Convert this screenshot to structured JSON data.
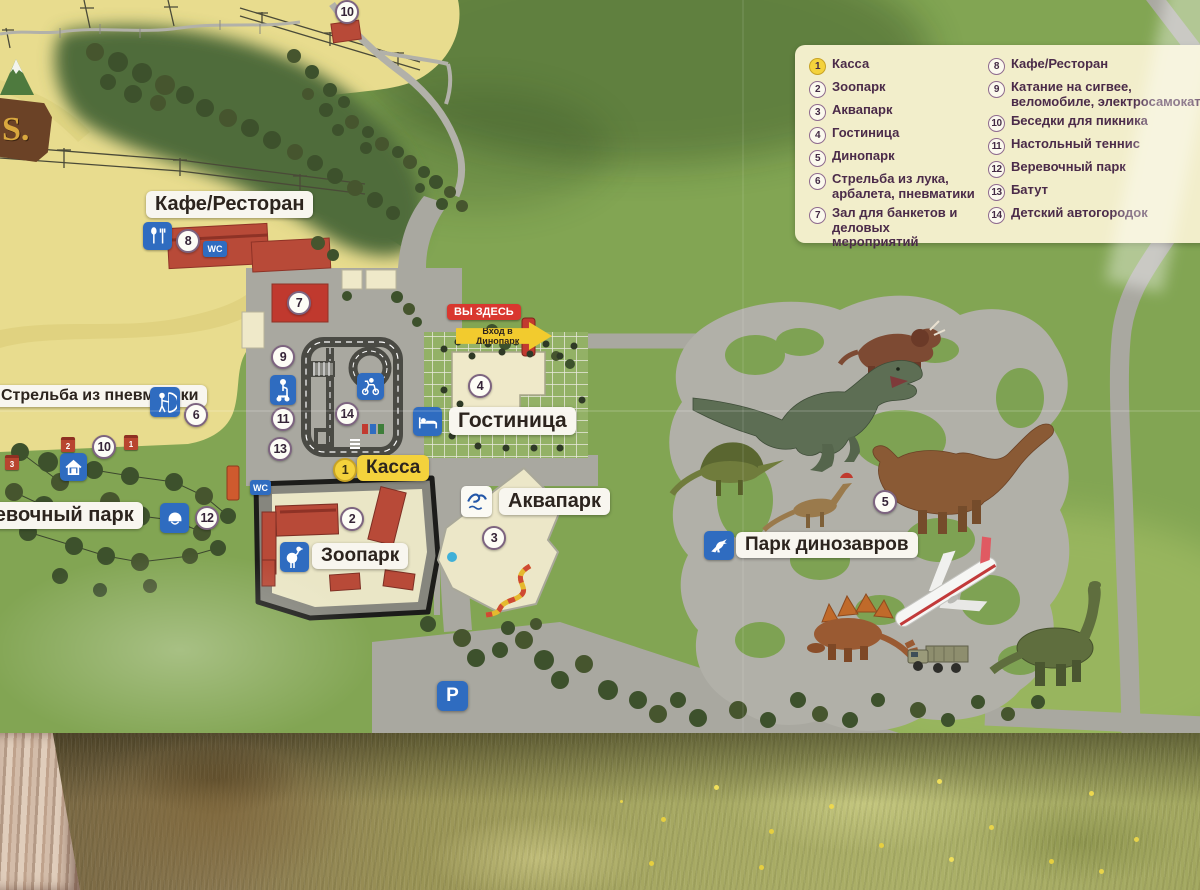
{
  "sign": {
    "legend": {
      "items": [
        {
          "num": "1",
          "label": "Касса",
          "highlight": true
        },
        {
          "num": "2",
          "label": "Зоопарк"
        },
        {
          "num": "3",
          "label": "Аквапарк"
        },
        {
          "num": "4",
          "label": "Гостиница"
        },
        {
          "num": "5",
          "label": "Динопарк"
        },
        {
          "num": "6",
          "label": "Стрельба из лука, арбалета, пневматики"
        },
        {
          "num": "7",
          "label": "Зал для банкетов и деловых мероприятий"
        },
        {
          "num": "8",
          "label": "Кафе/Ресторан"
        },
        {
          "num": "9",
          "label": "Катание на сигвее, веломобиле, электросамокате"
        },
        {
          "num": "10",
          "label": "Беседки для пикника"
        },
        {
          "num": "11",
          "label": "Настольный теннис"
        },
        {
          "num": "12",
          "label": "Веревочный парк"
        },
        {
          "num": "13",
          "label": "Батут"
        },
        {
          "num": "14",
          "label": "Детский автогородок"
        }
      ]
    },
    "labels": {
      "cafe": "Кафе/Ресторан",
      "shooting_range": "Стрельба из пневматики",
      "rope_park": "Веревочный парк",
      "zoo": "Зоопарк",
      "ticket_office": "Касса",
      "hotel": "Гостиница",
      "aquapark": "Аквапарк",
      "dino_park": "Парк динозавров",
      "you_are_here": "ВЫ ЗДЕСЬ",
      "dino_entrance": "Вход в Динопарк",
      "wc": "WC",
      "parking": "P",
      "logo": "S."
    },
    "markers": {
      "m1": "1",
      "m2": "2",
      "m3": "3",
      "m4": "4",
      "m5": "5",
      "m6": "6",
      "m7": "7",
      "m8": "8",
      "m9": "9",
      "m10": "10",
      "m11": "11",
      "m12": "12",
      "m13": "13",
      "m14": "14",
      "gazebo1": "1",
      "gazebo2": "2",
      "gazebo3": "3"
    },
    "colors": {
      "marker_highlight": "#f4d23c",
      "badge_blue": "#2f6cc0",
      "label_bg": "#f8f6ef",
      "you_are_here_bg": "#d9372f",
      "legend_bg": "#f2eecb",
      "legend_text": "#4b2b49",
      "map_green": "#82a553",
      "slope_yellow": "#e8dc8e"
    },
    "icons": [
      "restaurant-icon",
      "wc-badge",
      "segway-icon",
      "moped-icon",
      "bed-icon",
      "aquapark-logo-icon",
      "ostrich-icon",
      "archer-icon",
      "picnic-house-icon",
      "helmet-icon",
      "dino-icon",
      "parking-icon"
    ]
  }
}
